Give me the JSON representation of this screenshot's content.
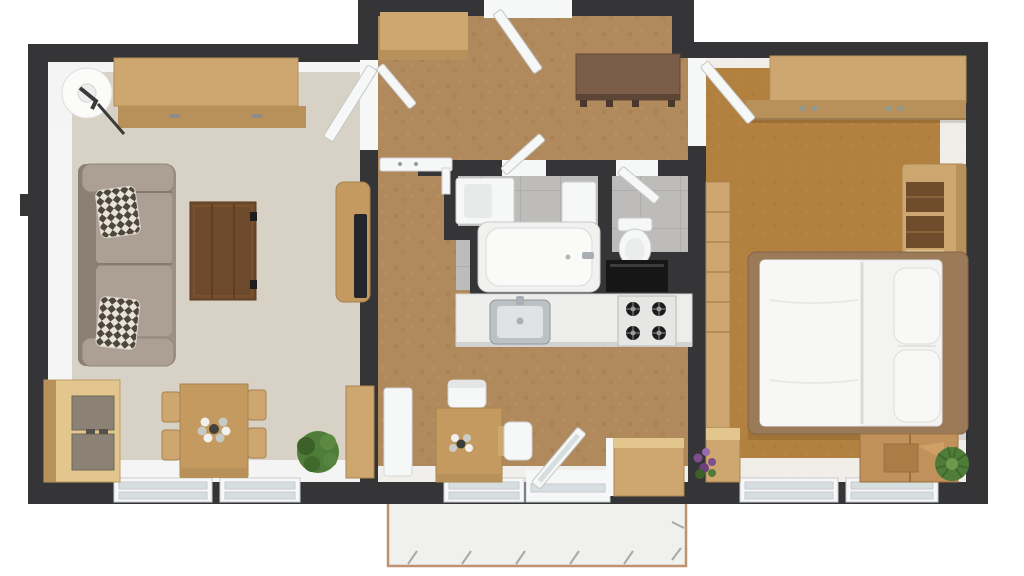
{
  "scene": {
    "type": "3d-floor-plan-top-view",
    "rooms": [
      {
        "name": "living-room",
        "floor": "light-greige-carpet",
        "items": [
          "credenza",
          "floor-lamp",
          "sofa",
          "throw-pillow",
          "throw-pillow",
          "coffee-table",
          "tv-stand",
          "tv",
          "media-cabinet",
          "dining-table",
          "dining-chair",
          "dining-chair",
          "dining-chair",
          "dining-chair",
          "centerpiece-flowers",
          "potted-plant",
          "tall-cabinet",
          "window",
          "window"
        ]
      },
      {
        "name": "entry-hall",
        "floor": "cork",
        "items": [
          "entry-door",
          "closet-shelf",
          "closet-door",
          "bench",
          "wall-shelf"
        ]
      },
      {
        "name": "bathroom",
        "floor": "gray-tile",
        "items": [
          "vanity-sink",
          "cabinet",
          "bathtub",
          "door"
        ]
      },
      {
        "name": "toilet-room",
        "floor": "gray-tile",
        "items": [
          "toilet",
          "door"
        ]
      },
      {
        "name": "kitchen",
        "floor": "cork",
        "items": [
          "countertop",
          "kitchen-sink",
          "gas-stove",
          "refrigerator",
          "breakfast-table",
          "chair",
          "chair",
          "flower-vase",
          "tall-white-cabinet",
          "base-cabinet",
          "sliding-glass-door",
          "window"
        ]
      },
      {
        "name": "bedroom",
        "floor": "brown-carpet",
        "items": [
          "wardrobe",
          "closet-unit",
          "shelf-dresser",
          "double-bed",
          "pillow",
          "pillow",
          "moving-box",
          "potted-plant",
          "flower-pot",
          "door",
          "window",
          "window"
        ]
      },
      {
        "name": "balcony",
        "floor": "concrete",
        "items": [
          "railing"
        ]
      }
    ]
  },
  "colors": {
    "background": "#ffffff",
    "wall": "#353537",
    "living_floor": "#d8d2c6",
    "hall_floor": "#b08a5c",
    "bedroom_floor": "#b2803f",
    "bath_floor": "#bdbcba",
    "balcony_floor": "#f0f0ee",
    "balcony_edge": "#bf9270",
    "white": "#f6f7f7",
    "glass": "#d7dee0",
    "wood_light": "#cda76f",
    "wood_front": "#b8905a",
    "wood_pale": "#e3c68d",
    "wood_medium": "#c49a61",
    "wood_dark": "#6d4a2b",
    "bench_wood": "#7b5d49",
    "panel_gray": "#8b8275",
    "sofa": "#9c9084",
    "sofa_light": "#aba093",
    "bed_frame": "#9b7a59",
    "mattress": "#f3f3f2",
    "cardboard": "#c0915a",
    "plant_green": "#4f7c38",
    "plant_dark": "#3c6128",
    "flower_purple": "#7d4f8d",
    "appliance_black": "#161616",
    "tv_black": "#23252a",
    "steel": "#a9afb4",
    "counter": "#ededec",
    "stove": "#e6e6e5",
    "burner": "#1c1c1c"
  }
}
